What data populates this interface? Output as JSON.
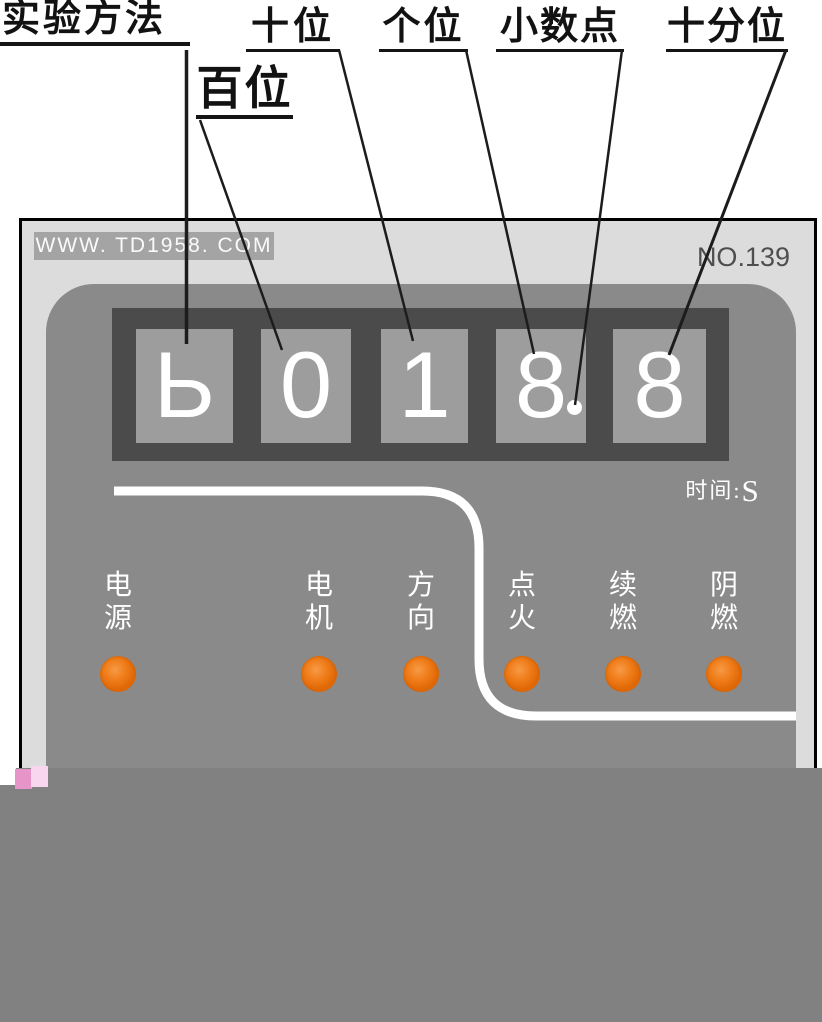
{
  "callouts": {
    "method": "实验方法",
    "hundreds": "百位",
    "tens": "十位",
    "units": "个位",
    "decimal_point": "小数点",
    "tenths": "十分位"
  },
  "panel": {
    "watermark": "WWW. TD1958. COM",
    "serial": "NO.139",
    "display": {
      "digits": [
        "Ь",
        "0",
        "1",
        "8",
        "8"
      ],
      "decimal_point_after_index": 3,
      "value_reading": "018.8",
      "unit_prefix": "时间:",
      "unit_value": "S"
    },
    "indicators": [
      {
        "name": "power",
        "chars": [
          "电",
          "源"
        ]
      },
      {
        "name": "motor",
        "chars": [
          "电",
          "机"
        ]
      },
      {
        "name": "direction",
        "chars": [
          "方",
          "向"
        ]
      },
      {
        "name": "ignition",
        "chars": [
          "点",
          "火"
        ]
      },
      {
        "name": "afterflame",
        "chars": [
          "续",
          "燃"
        ]
      },
      {
        "name": "smolder",
        "chars": [
          "阴",
          "燃"
        ]
      }
    ],
    "colors": {
      "panel_face": "#8a8a8a",
      "bezel": "#4b4b4b",
      "digit_cell": "#9d9d9d",
      "led": "#ef7d1a",
      "outer_panel": "#dcdcdc",
      "bottom_block": "#818181"
    }
  }
}
